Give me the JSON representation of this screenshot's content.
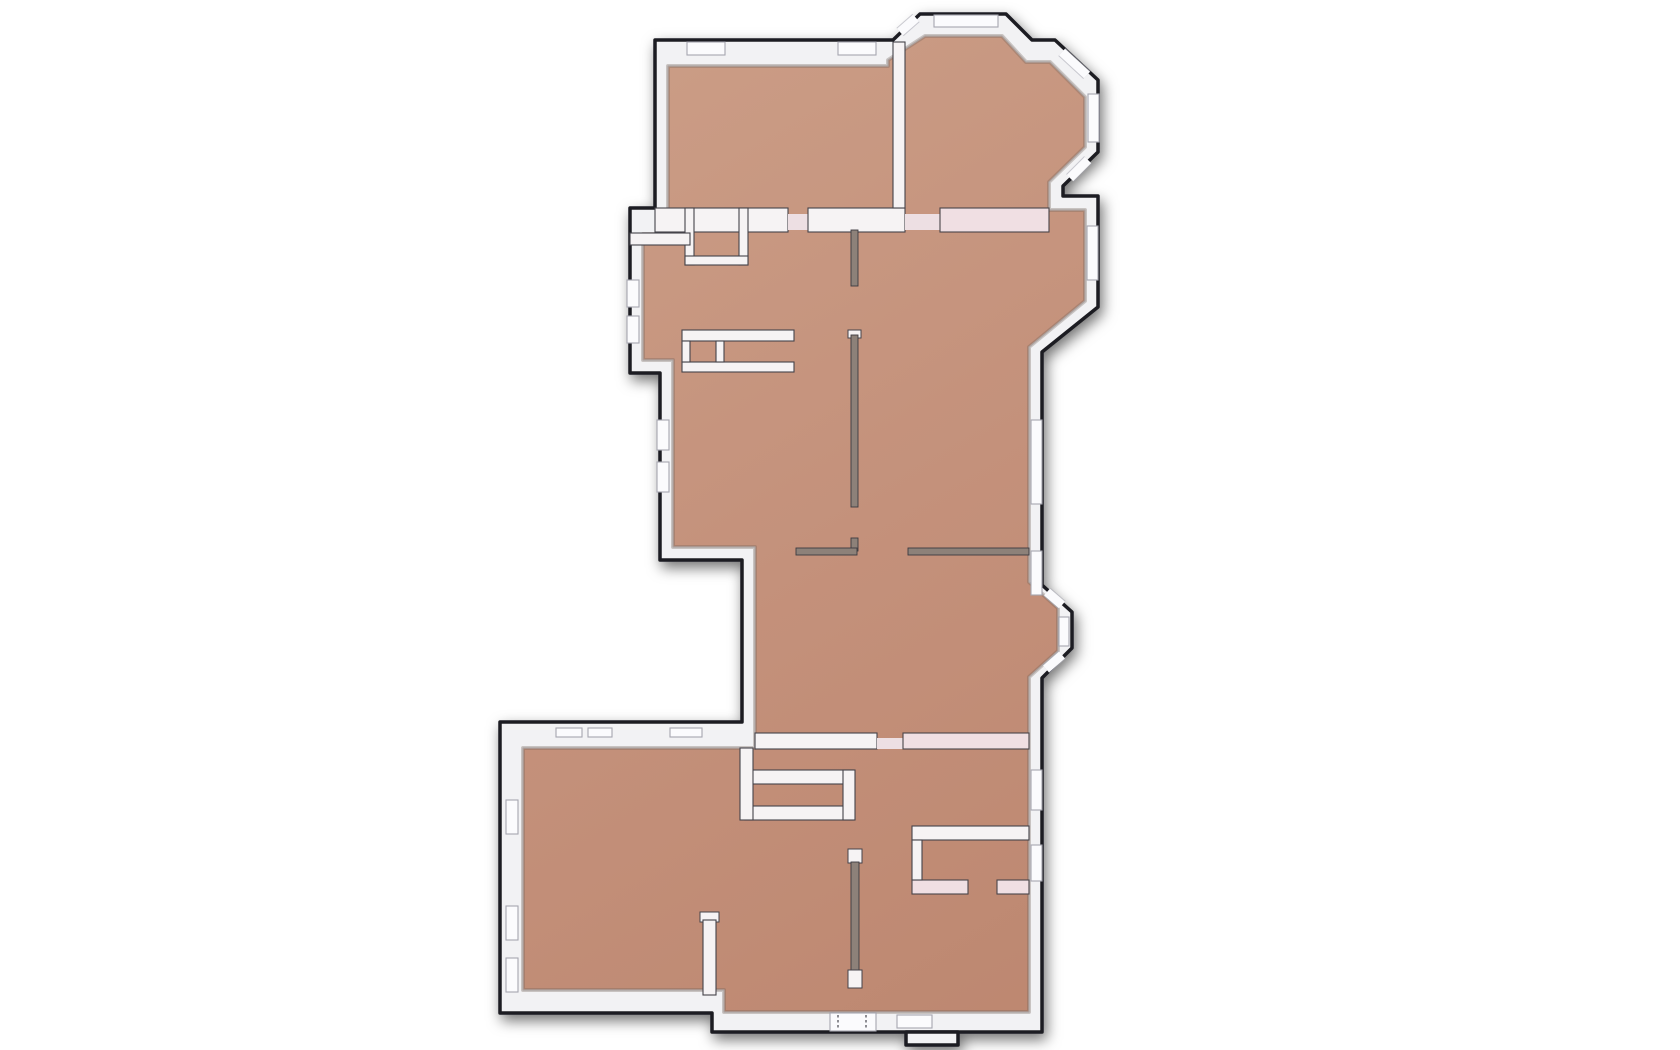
{
  "scene": {
    "name": "apartment-floor-plan-3d-top-view",
    "description": "Top-down orthographic 3D render of an apartment floor plan with white walls and tan floors on a plain white background. No text, labels, UI controls or dimensions are visible in the image.",
    "visible_text": [],
    "regions": [
      "bedroom-top-left",
      "bedroom-top-right-with-bay-windows",
      "living-area-middle",
      "corridor-middle-right",
      "living-room-bottom-left",
      "entry-hall-bottom-middle",
      "bedroom-bottom-right",
      "wardrobe-closets"
    ],
    "features": {
      "window_count": 24,
      "door_openings": 6,
      "entrance_door_with_dashed_marks": 1,
      "bay_windows": 3
    }
  },
  "palette": {
    "background": "#ffffff",
    "floor": "#c4917b",
    "floor_light": "#cb9d86",
    "floor_dark": "#bd8770",
    "wall": "#f2f2f4",
    "wall_inner_line": "#c9c4c6",
    "outline": "#1c1c20",
    "interior_wall": "#f6f3f4",
    "interior_wall_pink": "#f0dfe3",
    "partition": "#8d8179",
    "window": "#fbfbfd",
    "window_frame": "#a6a6b0",
    "threshold": "#eddfe3",
    "door_mark": "#5f5f66"
  }
}
